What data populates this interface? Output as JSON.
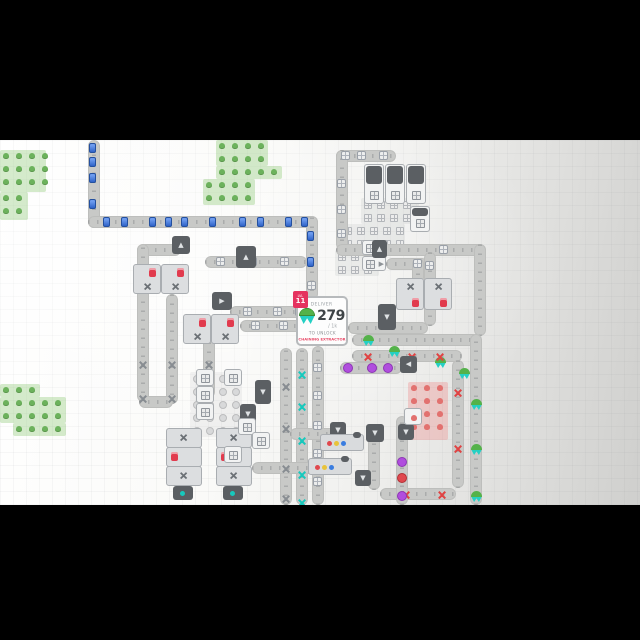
{
  "game": "shapez factory view",
  "hub": {
    "level_label": "LVL",
    "level_number": "11",
    "deliver_label": "DELIVER",
    "amount": "279",
    "goal": "/ 1k",
    "unlock_label": "TO UNLOCK",
    "reward": "CHAINING EXTRACTOR",
    "shape_icon": "green-circle-top-cyan-star-bottom"
  },
  "colors": {
    "accent_red": "#e5335f",
    "reward_red": "#e84a68",
    "belt_gray": "#c8c9c7",
    "item_blue": "#2f63c8",
    "item_red": "#e04343",
    "item_cyan": "#17c9bd",
    "item_purple": "#b04ede",
    "item_green": "#54b24a",
    "patch_green": "#84c46a",
    "patch_red": "#f06a6a",
    "machine_dark": "#5b5f63",
    "letterbox": "#000000"
  },
  "patches": [
    {
      "kind": "green",
      "rects": [
        [
          0,
          150,
          46,
          42
        ],
        [
          0,
          192,
          28,
          28
        ]
      ]
    },
    {
      "kind": "green",
      "rects": [
        [
          216,
          140,
          52,
          26
        ],
        [
          216,
          166,
          66,
          13
        ],
        [
          203,
          179,
          52,
          26
        ]
      ]
    },
    {
      "kind": "green",
      "rects": [
        [
          0,
          384,
          40,
          13
        ],
        [
          0,
          397,
          66,
          26
        ],
        [
          13,
          423,
          53,
          13
        ]
      ]
    },
    {
      "kind": "window",
      "rects": [
        [
          361,
          198,
          58,
          26
        ],
        [
          341,
          224,
          64,
          26
        ],
        [
          335,
          250,
          44,
          26
        ]
      ]
    },
    {
      "kind": "circle",
      "rects": [
        [
          190,
          372,
          52,
          39
        ],
        [
          190,
          411,
          66,
          26
        ]
      ]
    },
    {
      "kind": "red",
      "rects": [
        [
          408,
          382,
          40,
          58
        ]
      ]
    }
  ],
  "belts": [
    {
      "x": 88,
      "y": 140,
      "dir": "v",
      "len": 88,
      "items": [
        [
          "blue",
          4
        ],
        [
          "blue",
          18
        ],
        [
          "blue",
          34
        ],
        [
          "blue",
          60
        ]
      ]
    },
    {
      "x": 88,
      "y": 216,
      "dir": "h",
      "len": 230,
      "items": [
        [
          "blue",
          16
        ],
        [
          "blue",
          34
        ],
        [
          "blue",
          62
        ],
        [
          "blue",
          78
        ],
        [
          "blue",
          94
        ],
        [
          "blue",
          122
        ],
        [
          "blue",
          152
        ],
        [
          "blue",
          170
        ],
        [
          "blue",
          198
        ],
        [
          "blue",
          214
        ]
      ]
    },
    {
      "x": 306,
      "y": 216,
      "dir": "v",
      "len": 84,
      "items": [
        [
          "blue",
          16
        ],
        [
          "blue",
          42
        ],
        [
          "window",
          66
        ]
      ]
    },
    {
      "x": 336,
      "y": 150,
      "dir": "h",
      "len": 60,
      "items": [
        [
          "window",
          6
        ],
        [
          "window",
          22
        ],
        [
          "window",
          44
        ]
      ]
    },
    {
      "x": 336,
      "y": 150,
      "dir": "v",
      "len": 100,
      "items": [
        [
          "window",
          30
        ],
        [
          "window",
          56
        ],
        [
          "window",
          80
        ]
      ]
    },
    {
      "x": 336,
      "y": 244,
      "dir": "h",
      "len": 150,
      "items": [
        [
          "window",
          36
        ],
        [
          "window",
          104
        ]
      ]
    },
    {
      "x": 474,
      "y": 244,
      "dir": "v",
      "len": 92,
      "items": []
    },
    {
      "x": 386,
      "y": 258,
      "dir": "h",
      "len": 42,
      "items": [
        [
          "window",
          28
        ]
      ]
    },
    {
      "x": 412,
      "y": 258,
      "dir": "v",
      "len": 26,
      "items": []
    },
    {
      "x": 424,
      "y": 252,
      "dir": "v",
      "len": 74,
      "items": [
        [
          "window",
          10
        ]
      ]
    },
    {
      "x": 137,
      "y": 244,
      "dir": "h",
      "len": 44,
      "items": []
    },
    {
      "x": 137,
      "y": 244,
      "dir": "v",
      "len": 158,
      "items": [
        [
          "xgray",
          116
        ],
        [
          "xgray",
          150
        ]
      ]
    },
    {
      "x": 205,
      "y": 256,
      "dir": "h",
      "len": 102,
      "items": [
        [
          "window",
          12
        ],
        [
          "window",
          44
        ],
        [
          "window",
          76
        ]
      ]
    },
    {
      "x": 166,
      "y": 294,
      "dir": "v",
      "len": 110,
      "items": [
        [
          "xgray",
          66
        ],
        [
          "xgray",
          100
        ]
      ]
    },
    {
      "x": 230,
      "y": 306,
      "dir": "h",
      "len": 78,
      "items": [
        [
          "window",
          14
        ],
        [
          "window",
          44
        ],
        [
          "window",
          66
        ]
      ]
    },
    {
      "x": 240,
      "y": 320,
      "dir": "h",
      "len": 68,
      "items": [
        [
          "window",
          12
        ],
        [
          "window",
          40
        ]
      ]
    },
    {
      "x": 203,
      "y": 320,
      "dir": "v",
      "len": 78,
      "items": [
        [
          "xgray",
          40
        ]
      ]
    },
    {
      "x": 139,
      "y": 396,
      "dir": "h",
      "len": 34,
      "items": []
    },
    {
      "x": 280,
      "y": 348,
      "dir": "v",
      "len": 157,
      "items": [
        [
          "xgray",
          34
        ],
        [
          "xgray",
          76
        ],
        [
          "xgray",
          116
        ],
        [
          "xgray",
          146
        ]
      ]
    },
    {
      "x": 296,
      "y": 348,
      "dir": "v",
      "len": 157,
      "items": [
        [
          "xcyan",
          22
        ],
        [
          "xcyan",
          54
        ],
        [
          "xcyan",
          88
        ],
        [
          "xcyan",
          122
        ],
        [
          "xcyan",
          150
        ]
      ]
    },
    {
      "x": 312,
      "y": 346,
      "dir": "v",
      "len": 159,
      "items": [
        [
          "window",
          18
        ],
        [
          "window",
          46
        ],
        [
          "window",
          76
        ],
        [
          "window",
          104
        ],
        [
          "window",
          132
        ]
      ]
    },
    {
      "x": 352,
      "y": 334,
      "dir": "h",
      "len": 128,
      "items": [
        [
          "green",
          12
        ],
        [
          "green",
          38
        ],
        [
          "green",
          84
        ],
        [
          "green",
          108
        ]
      ]
    },
    {
      "x": 470,
      "y": 334,
      "dir": "v",
      "len": 171,
      "items": [
        [
          "green",
          22
        ],
        [
          "green",
          56
        ],
        [
          "green",
          92
        ],
        [
          "green",
          128
        ],
        [
          "green",
          160
        ]
      ]
    },
    {
      "x": 352,
      "y": 350,
      "dir": "h",
      "len": 110,
      "items": [
        [
          "xred",
          12
        ],
        [
          "xred",
          56
        ],
        [
          "xred",
          84
        ]
      ]
    },
    {
      "x": 452,
      "y": 360,
      "dir": "v",
      "len": 128,
      "items": [
        [
          "xred",
          28
        ],
        [
          "xred",
          84
        ]
      ]
    },
    {
      "x": 380,
      "y": 488,
      "dir": "h",
      "len": 76,
      "items": [
        [
          "xred",
          22
        ],
        [
          "xred",
          58
        ]
      ]
    },
    {
      "x": 340,
      "y": 362,
      "dir": "h",
      "len": 62,
      "items": [
        [
          "dotpurple",
          4
        ],
        [
          "dotpurple",
          28
        ],
        [
          "dotpurple",
          44
        ]
      ]
    },
    {
      "x": 348,
      "y": 322,
      "dir": "h",
      "len": 80,
      "items": []
    },
    {
      "x": 290,
      "y": 428,
      "dir": "h",
      "len": 46,
      "items": []
    },
    {
      "x": 252,
      "y": 462,
      "dir": "h",
      "len": 64,
      "items": []
    },
    {
      "x": 368,
      "y": 432,
      "dir": "v",
      "len": 58,
      "items": []
    },
    {
      "x": 396,
      "y": 416,
      "dir": "v",
      "len": 89,
      "items": [
        [
          "dotpurple",
          42
        ],
        [
          "dotred",
          58
        ],
        [
          "dotpurple",
          76
        ]
      ]
    },
    {
      "x": 218,
      "y": 438,
      "dir": "h",
      "len": 34,
      "items": []
    }
  ],
  "buildings": [
    {
      "kind": "miner",
      "x": 364,
      "y": 164,
      "w": 20,
      "h": 40
    },
    {
      "kind": "miner",
      "x": 385,
      "y": 164,
      "w": 20,
      "h": 40
    },
    {
      "kind": "miner",
      "x": 406,
      "y": 164,
      "w": 20,
      "h": 40
    },
    {
      "kind": "miner",
      "x": 410,
      "y": 206,
      "w": 20,
      "h": 26
    },
    {
      "kind": "feeder",
      "x": 362,
      "y": 240,
      "w": 24,
      "h": 15
    },
    {
      "kind": "feeder",
      "x": 362,
      "y": 256,
      "w": 24,
      "h": 15
    },
    {
      "kind": "proc",
      "x": 133,
      "y": 264,
      "w": 28,
      "h": 30
    },
    {
      "kind": "proc",
      "x": 161,
      "y": 264,
      "w": 28,
      "h": 30
    },
    {
      "kind": "proc",
      "x": 183,
      "y": 314,
      "w": 28,
      "h": 30
    },
    {
      "kind": "proc",
      "x": 211,
      "y": 314,
      "w": 28,
      "h": 30
    },
    {
      "kind": "proc2",
      "x": 396,
      "y": 278,
      "w": 28,
      "h": 32
    },
    {
      "kind": "proc2",
      "x": 424,
      "y": 278,
      "w": 28,
      "h": 32
    },
    {
      "kind": "tunnel",
      "x": 172,
      "y": 236,
      "w": 18,
      "h": 18,
      "o": "up"
    },
    {
      "kind": "tunnel",
      "x": 212,
      "y": 292,
      "w": 20,
      "h": 18,
      "o": "right"
    },
    {
      "kind": "tunnel",
      "x": 236,
      "y": 246,
      "w": 20,
      "h": 22,
      "o": "up"
    },
    {
      "kind": "tunnel",
      "x": 372,
      "y": 240,
      "w": 15,
      "h": 18,
      "o": "up"
    },
    {
      "kind": "tunnel",
      "x": 378,
      "y": 304,
      "w": 18,
      "h": 26,
      "o": "down"
    },
    {
      "kind": "tunnel",
      "x": 400,
      "y": 356,
      "w": 17,
      "h": 17,
      "o": "left"
    },
    {
      "kind": "tunnel",
      "x": 330,
      "y": 422,
      "w": 16,
      "h": 16,
      "o": "down"
    },
    {
      "kind": "tunnel",
      "x": 366,
      "y": 424,
      "w": 18,
      "h": 18,
      "o": "down"
    },
    {
      "kind": "tunnel",
      "x": 398,
      "y": 424,
      "w": 16,
      "h": 16,
      "o": "down"
    },
    {
      "kind": "tunnel",
      "x": 255,
      "y": 380,
      "w": 16,
      "h": 24,
      "o": "down"
    },
    {
      "kind": "tunnel",
      "x": 240,
      "y": 404,
      "w": 16,
      "h": 20,
      "o": "down"
    },
    {
      "kind": "tunnel",
      "x": 355,
      "y": 470,
      "w": 16,
      "h": 16,
      "o": "down"
    },
    {
      "kind": "painter",
      "x": 320,
      "y": 434,
      "w": 44,
      "h": 17
    },
    {
      "kind": "painter",
      "x": 308,
      "y": 458,
      "w": 44,
      "h": 17
    },
    {
      "kind": "tower",
      "x": 166,
      "y": 428,
      "w": 34,
      "h": 72
    },
    {
      "kind": "tower",
      "x": 216,
      "y": 428,
      "w": 34,
      "h": 72
    },
    {
      "kind": "minersq",
      "x": 196,
      "y": 369,
      "w": 18,
      "h": 17
    },
    {
      "kind": "minersq",
      "x": 196,
      "y": 386,
      "w": 18,
      "h": 17
    },
    {
      "kind": "minersq",
      "x": 196,
      "y": 403,
      "w": 18,
      "h": 17
    },
    {
      "kind": "minersq",
      "x": 224,
      "y": 369,
      "w": 18,
      "h": 17
    },
    {
      "kind": "minersq",
      "x": 238,
      "y": 418,
      "w": 18,
      "h": 17
    },
    {
      "kind": "minersq",
      "x": 252,
      "y": 432,
      "w": 18,
      "h": 17
    },
    {
      "kind": "minersq",
      "x": 224,
      "y": 446,
      "w": 18,
      "h": 17
    },
    {
      "kind": "minerred",
      "x": 404,
      "y": 408,
      "w": 18,
      "h": 17
    }
  ]
}
